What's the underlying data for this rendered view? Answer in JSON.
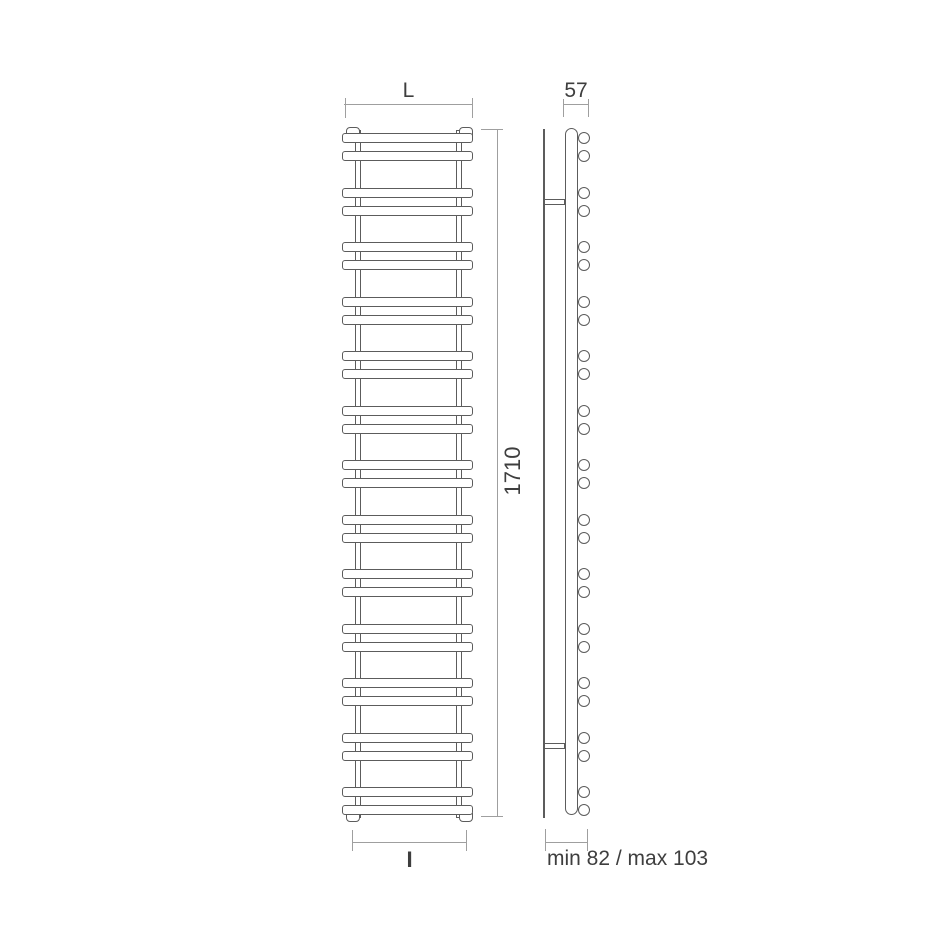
{
  "diagram": {
    "type": "technical-drawing"
  },
  "dimensions": {
    "width_label": "L",
    "height_value": "1710",
    "depth_value": "57",
    "interaxis_label": "I",
    "wall_clearance": "min 82 / max 103"
  },
  "structure": {
    "rung_pairs": 13,
    "bars_per_pair": 2,
    "total_bars": 26
  },
  "colors": {
    "object_line": "#5c5c5c",
    "dimension_line": "#9f9f9f",
    "text": "#3e3e3e",
    "background": "#ffffff"
  }
}
